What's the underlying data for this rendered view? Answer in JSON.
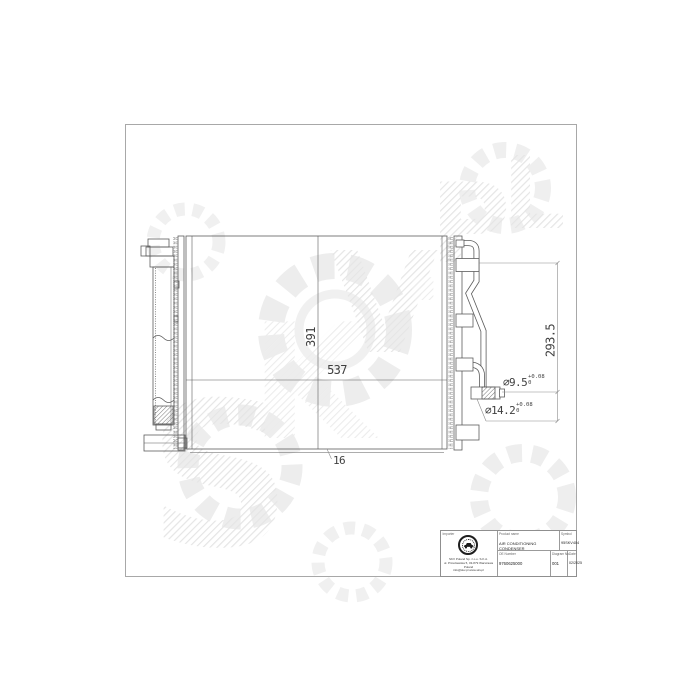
{
  "watermark": {
    "text": "SKV.PL",
    "letters": [
      "S",
      "K",
      "V",
      ".",
      "P",
      "L"
    ],
    "hatch_color": "#e5e5e5",
    "gear_color": "#ededed"
  },
  "drawing": {
    "line_color": "#5c5c5c",
    "dim_height": "391",
    "dim_width": "537",
    "dim_depth": "16",
    "dim_connector_span": "293.5",
    "port_small": {
      "dia": "⌀9.5",
      "tol_upper": "+0.08",
      "tol_lower": "0"
    },
    "port_large": {
      "dia": "⌀14.2",
      "tol_upper": "+0.08",
      "tol_lower": "0"
    }
  },
  "title_block": {
    "importer": {
      "label": "Importer",
      "stamp_icon": "car-stamp",
      "address_lines": [
        "SKV Poland Sp. z o.o. S.K.A.",
        "ul. Przeclawska 5, 03-879 Warszawa Poland",
        "info@skv.pl  www.skv.pl"
      ]
    },
    "product_name": {
      "label": "Product name",
      "value": "AIR CONDITIONING CONDENSER"
    },
    "symbol": {
      "label": "Symbol",
      "value": "95SKV404"
    },
    "oe_number": {
      "label": "OE Number",
      "value": "9760625000"
    },
    "diagram_no": {
      "label": "Diagram No.",
      "value": "001"
    },
    "date": {
      "label": "Date",
      "value": "02/2025"
    }
  }
}
